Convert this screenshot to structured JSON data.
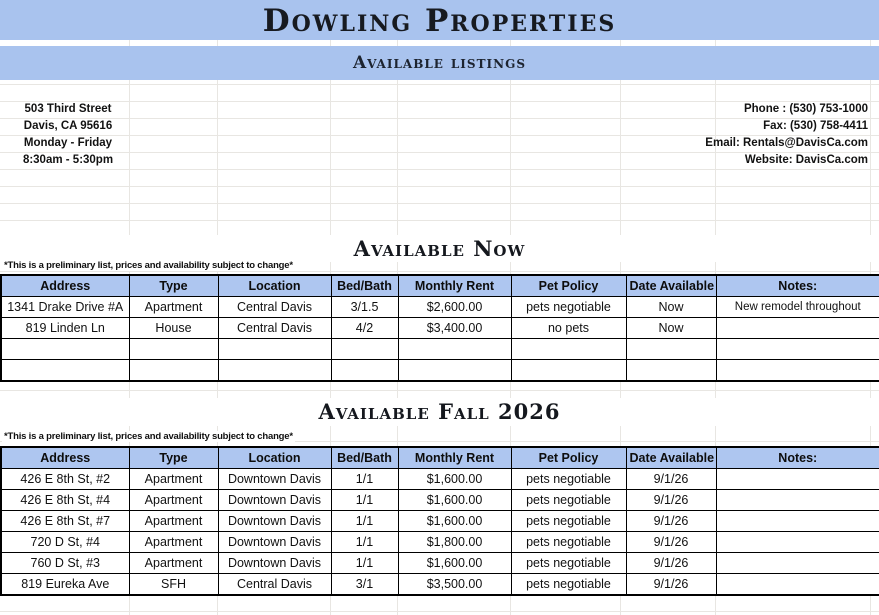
{
  "page": {
    "title": "Dowling Properties",
    "subtitle": "Available listings"
  },
  "colors": {
    "band_blue": "#a9c3ee",
    "table_header_blue": "#aec6f0",
    "grid_line": "#e8e6e2",
    "border_black": "#000000"
  },
  "contact": {
    "left": [
      "503 Third Street",
      "Davis, CA 95616",
      "Monday - Friday",
      "8:30am - 5:30pm"
    ],
    "right": [
      "Phone : (530) 753-1000",
      "Fax: (530) 758-4411",
      "Email: Rentals@DavisCa.com",
      "Website: DavisCa.com"
    ]
  },
  "sections": [
    {
      "title": "Available Now",
      "note": "*This is a preliminary list, prices and availability subject to change*",
      "headers": [
        "Address",
        "Type",
        "Location",
        "Bed/Bath",
        "Monthly Rent",
        "Pet Policy",
        "Date Available",
        "Notes:"
      ],
      "rows": [
        [
          "1341 Drake Drive #A",
          "Apartment",
          "Central Davis",
          "3/1.5",
          "$2,600.00",
          "pets negotiable",
          "Now",
          "New remodel throughout"
        ],
        [
          "819 Linden Ln",
          "House",
          "Central Davis",
          "4/2",
          "$3,400.00",
          "no pets",
          "Now",
          ""
        ],
        [
          "",
          "",
          "",
          "",
          "",
          "",
          "",
          ""
        ],
        [
          "",
          "",
          "",
          "",
          "",
          "",
          "",
          ""
        ]
      ]
    },
    {
      "title": "Available Fall 2026",
      "note": "*This is a preliminary list, prices and availability subject to change*",
      "headers": [
        "Address",
        "Type",
        "Location",
        "Bed/Bath",
        "Monthly Rent",
        "Pet Policy",
        "Date Available",
        "Notes:"
      ],
      "rows": [
        [
          "426 E 8th St, #2",
          "Apartment",
          "Downtown Davis",
          "1/1",
          "$1,600.00",
          "pets negotiable",
          "9/1/26",
          ""
        ],
        [
          "426 E 8th St, #4",
          "Apartment",
          "Downtown Davis",
          "1/1",
          "$1,600.00",
          "pets negotiable",
          "9/1/26",
          ""
        ],
        [
          "426 E 8th St, #7",
          "Apartment",
          "Downtown Davis",
          "1/1",
          "$1,600.00",
          "pets negotiable",
          "9/1/26",
          ""
        ],
        [
          "720 D St, #4",
          "Apartment",
          "Downtown Davis",
          "1/1",
          "$1,800.00",
          "pets negotiable",
          "9/1/26",
          ""
        ],
        [
          "760 D St, #3",
          "Apartment",
          "Downtown Davis",
          "1/1",
          "$1,600.00",
          "pets negotiable",
          "9/1/26",
          ""
        ],
        [
          "819 Eureka Ave",
          "SFH",
          "Central Davis",
          "3/1",
          "$3,500.00",
          "pets negotiable",
          "9/1/26",
          ""
        ]
      ]
    }
  ]
}
